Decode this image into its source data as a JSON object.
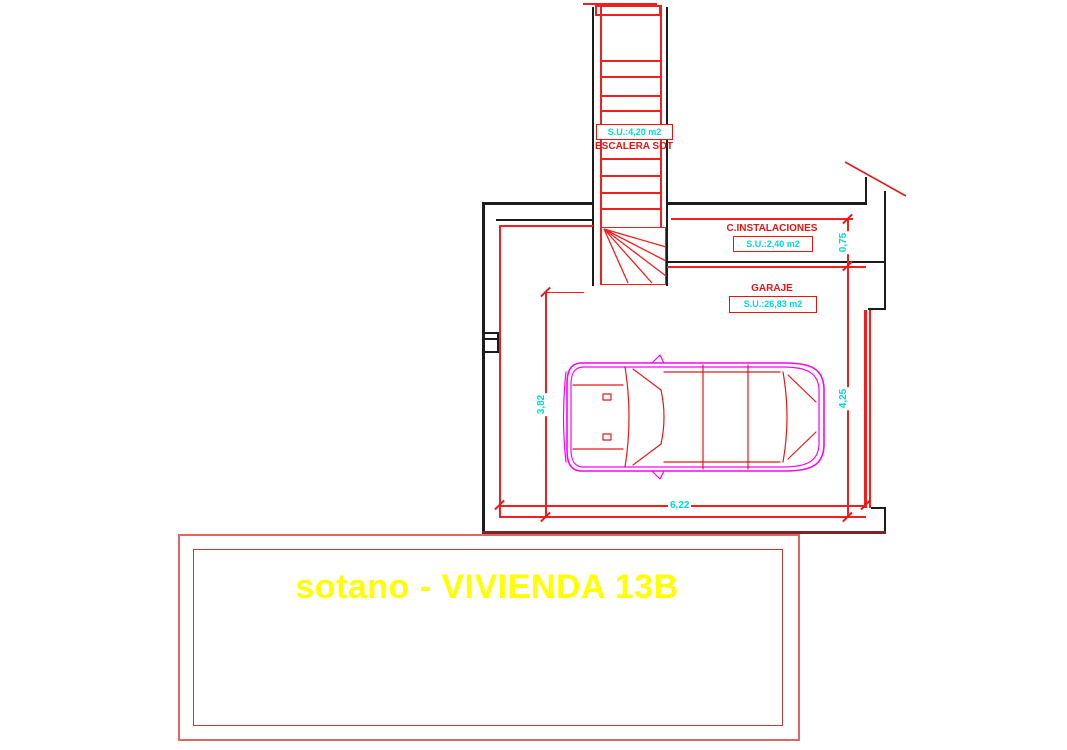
{
  "plan": {
    "title": "sotano - VIVIENDA 13B",
    "rooms": {
      "stairs": {
        "name": "ESCALERA SOT",
        "area": "S.U.:4,20 m2"
      },
      "utilities": {
        "name": "C.INSTALACIONES",
        "area": "S.U.:2,40 m2"
      },
      "garage": {
        "name": "GARAJE",
        "area": "S.U.:26,83 m2"
      }
    },
    "dimensions": {
      "utilities_depth": "0,75",
      "garage_height_left": "3,82",
      "garage_height_right": "4,25",
      "garage_width": "6,22"
    },
    "colors": {
      "wall_black": "#1c1c1c",
      "line_red": "#f02020",
      "dim_cyan": "#00d8d8",
      "car_magenta": "#ff00ff",
      "title_yellow": "#ffff00",
      "frame_outer_red": "#e06666",
      "frame_inner_red": "#c43b3b"
    }
  }
}
